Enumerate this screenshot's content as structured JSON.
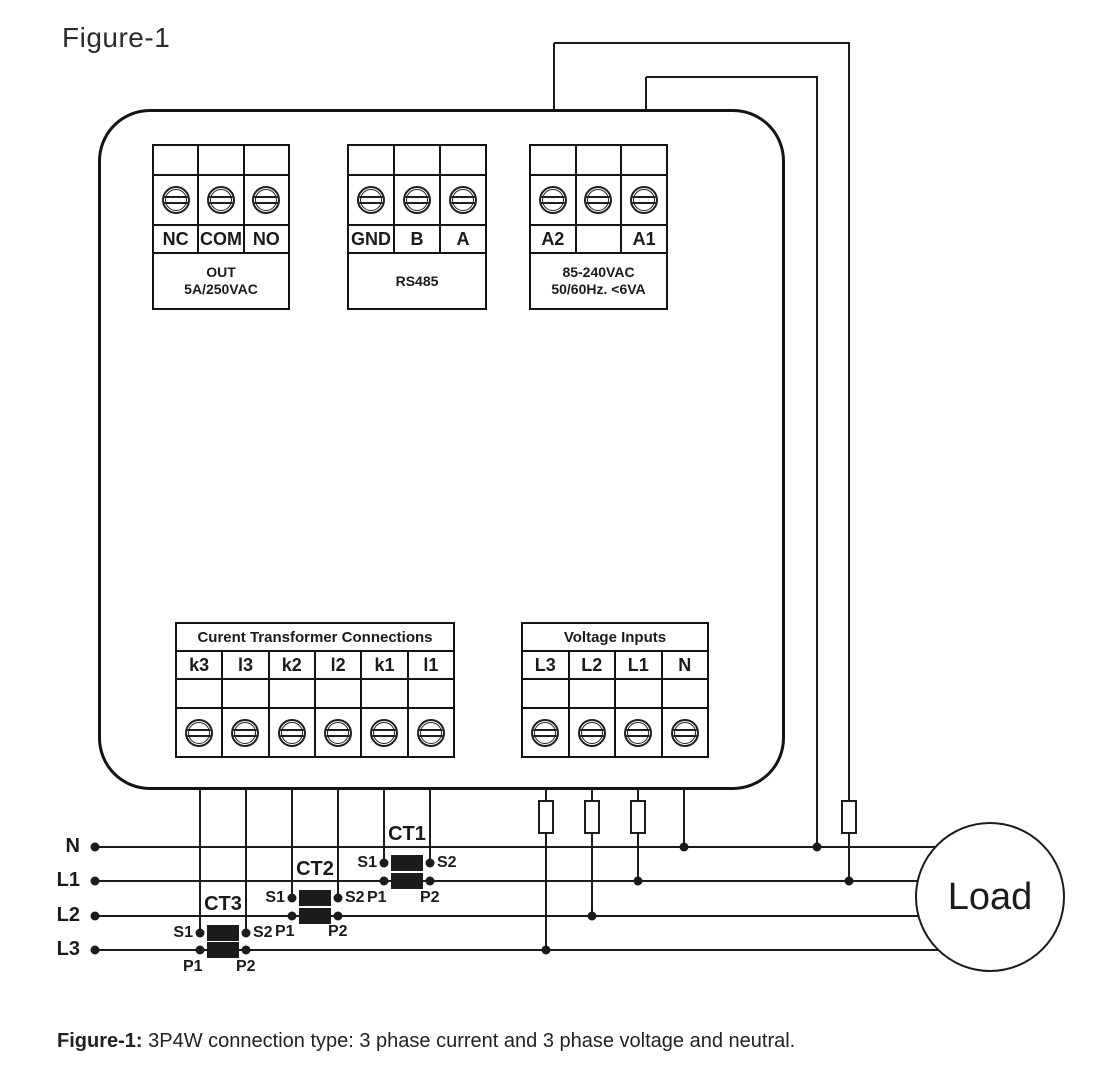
{
  "title": "Figure-1",
  "caption": {
    "label": "Figure-1:",
    "text": "3P4W connection type: 3 phase current and 3 phase voltage and neutral."
  },
  "relay_block": {
    "labels": [
      "NC",
      "COM",
      "NO"
    ],
    "desc_line1": "OUT",
    "desc_line2": "5A/250VAC"
  },
  "rs485_block": {
    "labels": [
      "GND",
      "B",
      "A"
    ],
    "desc_line1": "RS485",
    "desc_line2": ""
  },
  "power_block": {
    "labels": [
      "A2",
      "",
      "A1"
    ],
    "desc_line1": "85-240VAC",
    "desc_line2": "50/60Hz. <6VA"
  },
  "ct_block": {
    "header": "Curent Transformer Connections",
    "labels": [
      "k3",
      "l3",
      "k2",
      "l2",
      "k1",
      "l1"
    ]
  },
  "voltage_block": {
    "header": "Voltage Inputs",
    "labels": [
      "L3",
      "L2",
      "L1",
      "N"
    ]
  },
  "phase_labels": {
    "n": "N",
    "l1": "L1",
    "l2": "L2",
    "l3": "L3"
  },
  "cts": {
    "ct1": {
      "name": "CT1",
      "s1": "S1",
      "s2": "S2",
      "p1": "P1",
      "p2": "P2"
    },
    "ct2": {
      "name": "CT2",
      "s1": "S1",
      "s2": "S2",
      "p1": "P1",
      "p2": "P2"
    },
    "ct3": {
      "name": "CT3",
      "s1": "S1",
      "s2": "S2",
      "p1": "P1",
      "p2": "P2"
    }
  },
  "load_label": "Load",
  "colors": {
    "line": "#1b1b1b",
    "fill": "#ffffff"
  }
}
